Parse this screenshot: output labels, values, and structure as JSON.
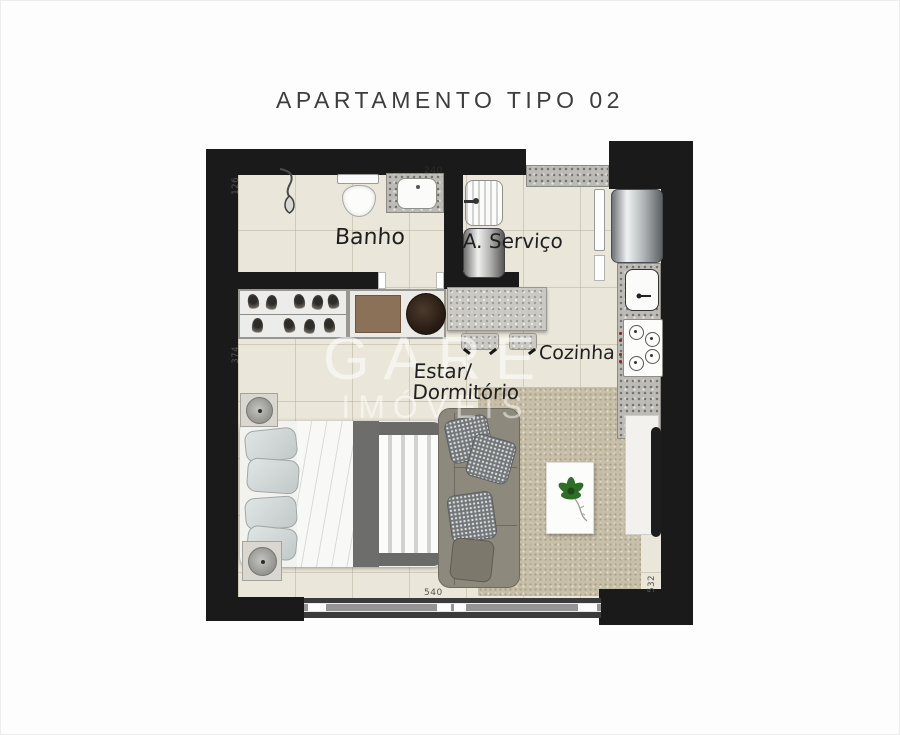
{
  "title": "APARTAMENTO TIPO 02",
  "watermark": {
    "brand": "GARE",
    "sub": "IMÓVEIS"
  },
  "rooms": {
    "banho": "Banho",
    "servico": "A. Serviço",
    "cozinha": "Cozinha",
    "estar_line1": "Estar/",
    "estar_line2": "Dormitório"
  },
  "dimensions": {
    "banho_height": "126",
    "banho_counter": "240",
    "estar_height": "374",
    "estar_width": "540",
    "living_right_height": "532"
  },
  "colors": {
    "wall": "#1a1a1a",
    "floor": "#eae6d9",
    "rug": "#c8bfa8",
    "granite": "#bcbbb5",
    "plant": "#2f6e27",
    "watermark_text": "#ffffff"
  }
}
